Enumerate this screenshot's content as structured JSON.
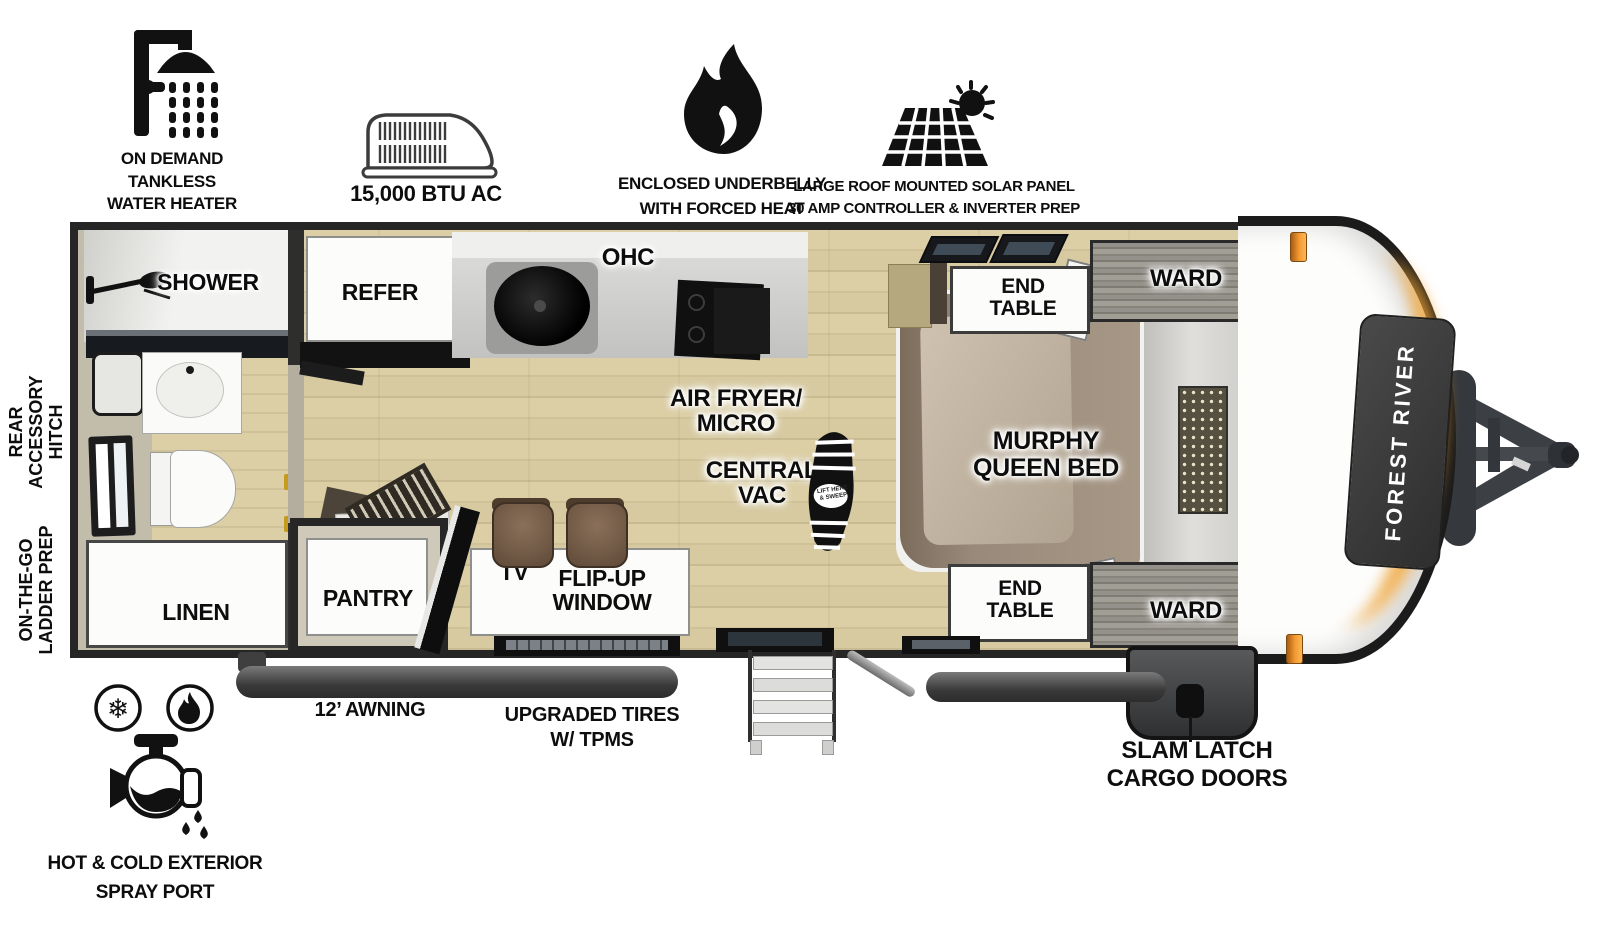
{
  "top_features": [
    {
      "icon": "shower-head-icon",
      "label": "ON DEMAND\nTANKLESS\nWATER HEATER"
    },
    {
      "icon": "rooftop-ac-icon",
      "label": "15,000 BTU AC"
    },
    {
      "icon": "flame-icon",
      "label": "ENCLOSED UNDERBELLY\nWITH FORCED HEAT"
    },
    {
      "icon": "solar-panel-sun-icon",
      "label": "LARGE ROOF MOUNTED SOLAR PANEL\n30 AMP CONTROLLER & INVERTER PREP"
    }
  ],
  "side_labels": {
    "rear_accessory_hitch": "REAR\nACCESSORY\nHITCH",
    "on_the_go_ladder_prep": "ON-THE-GO\nLADDER PREP"
  },
  "rooms": {
    "shower": "SHOWER",
    "linen": "LINEN",
    "refer": "REFER",
    "ohc": "OHC",
    "pantry": "PANTRY",
    "tv": "TV",
    "flip_up_window": "FLIP-UP\nWINDOW",
    "air_fryer_micro": "AIR FRYER/\nMICRO",
    "central_vac": "CENTRAL\nVAC",
    "murphy_queen_bed": "MURPHY\nQUEEN BED",
    "end_table_top": "END\nTABLE",
    "end_table_bottom": "END\nTABLE",
    "ward_top": "WARD",
    "ward_bottom": "WARD"
  },
  "exterior_labels": {
    "awning": "12’ AWNING",
    "tires": "UPGRADED TIRES\nW/ TPMS",
    "cargo_doors": "SLAM LATCH\nCARGO DOORS",
    "spray_port": "HOT & COLD EXTERIOR\nSPRAY PORT"
  },
  "brand_panel": {
    "label": "FOREST RIVER"
  },
  "bootprint_text": "LIFT HERE\n& SWEEP",
  "colors": {
    "floor_wood": "#d9cda4",
    "wall_dark": "#262626",
    "accent_orange": "#f5a033",
    "bed_brown": "#94846f",
    "ward_wood_gray": "#8d8a82"
  }
}
